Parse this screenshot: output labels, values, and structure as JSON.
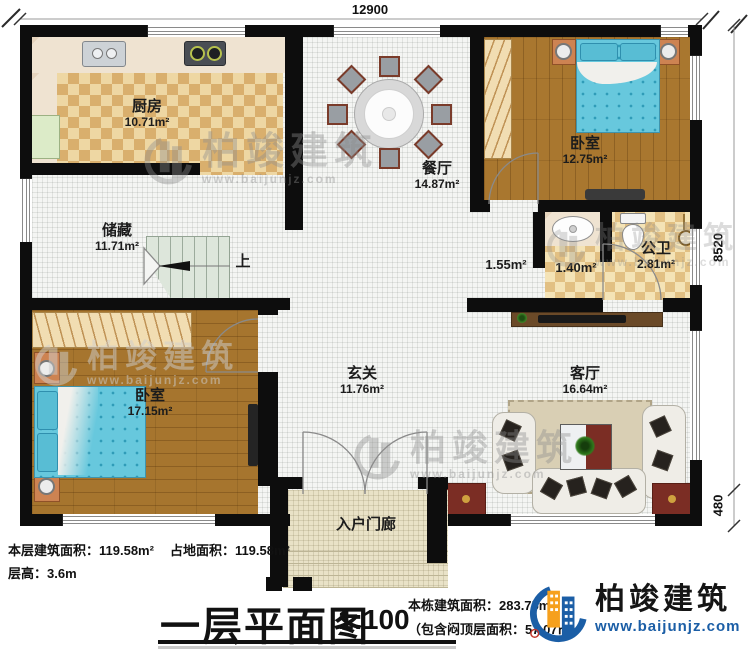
{
  "dimensions": {
    "top": "12900",
    "right_upper": "8520",
    "right_lower": "480"
  },
  "rooms": {
    "kitchen": {
      "name": "厨房",
      "area": "10.71m²"
    },
    "storage": {
      "name": "储藏",
      "area": "11.71m²"
    },
    "dining": {
      "name": "餐厅",
      "area": "14.87m²"
    },
    "bedroom_top": {
      "name": "卧室",
      "area": "12.75m²"
    },
    "bathroom": {
      "name": "公卫",
      "area": "2.81m²"
    },
    "hall_small": {
      "area": "1.55m²"
    },
    "washroom": {
      "area": "1.40m²"
    },
    "bedroom_left": {
      "name": "卧室",
      "area": "17.15m²"
    },
    "foyer": {
      "name": "玄关",
      "area": "11.76m²"
    },
    "living": {
      "name": "客厅",
      "area": "16.64m²"
    },
    "porch": {
      "name": "入户门廊"
    },
    "stairs": {
      "up_label": "上"
    }
  },
  "footer": {
    "floor_area": "本层建筑面积：119.58m²",
    "land_area": "占地面积：119.58m²",
    "floor_height": "层高：3.6m",
    "plan_title": "一层平面图",
    "scale": "1:100",
    "total_area": "本栋建筑面积：283.75m²",
    "attic_area": "（包含闷顶层面积：57.07㎡）"
  },
  "brand": {
    "name": "柏竣建筑",
    "url": "www.baijunjz.com"
  },
  "watermark": {
    "name": "柏竣建筑",
    "url": "www.baijunjz.com"
  },
  "colors": {
    "wall": "#0d0d0d",
    "brand_blue": "#1b5ea6",
    "brand_orange": "#f6a01d"
  }
}
